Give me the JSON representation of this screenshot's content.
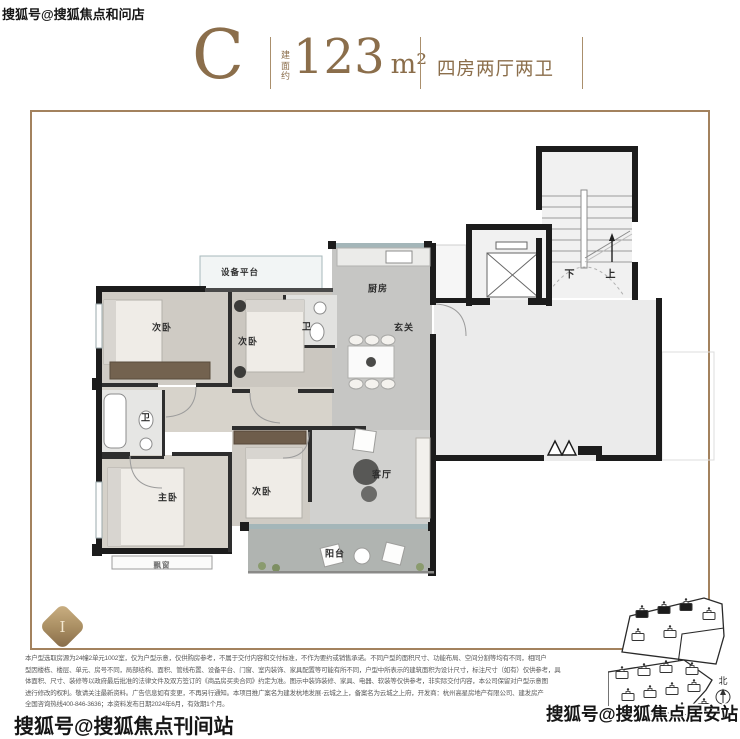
{
  "header": {
    "unit_letter": "C",
    "area_prefix": "建面约",
    "area_value": "123",
    "area_unit": "m²",
    "layout_text": "四房两厅两卫"
  },
  "watermarks": {
    "top_left": "搜狐号@搜狐焦点和问店",
    "bottom_left": "搜狐号@搜狐焦点刊间站",
    "bottom_right": "搜狐号@搜狐焦点居安站"
  },
  "badge": {
    "letter": "I"
  },
  "floorplan": {
    "labels": [
      {
        "text": "设备平台",
        "x": 240,
        "y": 272,
        "size": 8.5
      },
      {
        "text": "厨房",
        "x": 378,
        "y": 288,
        "size": 9
      },
      {
        "text": "玄关",
        "x": 404,
        "y": 327,
        "size": 9
      },
      {
        "text": "次卧",
        "x": 162,
        "y": 327,
        "size": 9
      },
      {
        "text": "次卧",
        "x": 248,
        "y": 341,
        "size": 9
      },
      {
        "text": "卫",
        "x": 307,
        "y": 326,
        "size": 9
      },
      {
        "text": "卫",
        "x": 146,
        "y": 417,
        "size": 9
      },
      {
        "text": "主卧",
        "x": 168,
        "y": 497,
        "size": 9
      },
      {
        "text": "次卧",
        "x": 262,
        "y": 491,
        "size": 9
      },
      {
        "text": "客厅",
        "x": 382,
        "y": 474,
        "size": 9
      },
      {
        "text": "阳台",
        "x": 335,
        "y": 553,
        "size": 9
      },
      {
        "text": "飘窗",
        "x": 162,
        "y": 565,
        "size": 7.5,
        "color": "#777777"
      },
      {
        "text": "下",
        "x": 570,
        "y": 273,
        "size": 10
      },
      {
        "text": "上",
        "x": 611,
        "y": 273,
        "size": 10
      }
    ]
  },
  "sitemap": {
    "north": "北"
  },
  "disclaimer": {
    "lines": [
      "本户型选取房源为24幢2单元1002室，仅为户型示意，仅供购房参考，不属于交付内容和交付标准，不作为要约或销售承诺。不同户型的面积尺寸、功能布局、空间分割等均有不同，相同户",
      "型因楼栋、楼层、单元、房号不同，局部结构、面积、管线布置、设备平台、门窗、室内装饰、家具配置等可能有所不同，户型中所表示的建筑面积为设计尺寸，标注尺寸（如有）仅供参考，具",
      "体面积、尺寸、装修等以政府最后批准的法律文件及双方签订的《商品房买卖合同》约定为准。图示中装饰装修、家具、电器、软装等仅供参考，非实际交付内容，本公司保留对户型示意图",
      "进行修改的权利。敬请关注最新资料。广告信息如有变更，不再另行通知。本项目推广案名为建发杭地发展·云城之上，备案名为云城之上府，开发商：杭州高星房地产有限公司、建发房产",
      "全国咨询热线400-846-3636；本资料发布日期2024年6月，有效期1个月。"
    ]
  },
  "colors": {
    "accent_brown": "#8b6e4b",
    "frame_border": "#a3825e",
    "wall_black": "#1c1c1c",
    "floor_gray": "#cfcbc4",
    "window_blue": "#a4b6b9"
  }
}
